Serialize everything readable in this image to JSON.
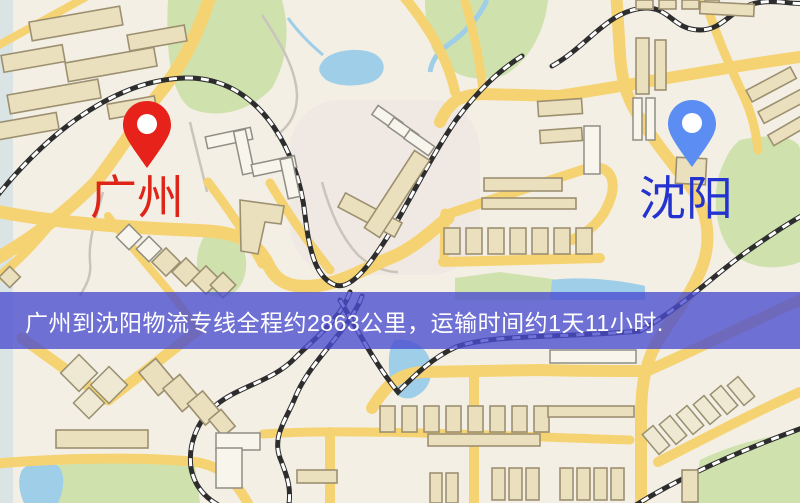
{
  "route_map": {
    "origin": {
      "name": "广州",
      "pin_color": "#e7221b",
      "label_color": "#df2418"
    },
    "destination": {
      "name": "沈阳",
      "pin_color": "#5b8df2",
      "label_color": "#2433cf"
    },
    "banner": {
      "text": "广州到沈阳物流专线全程约2863公里，运输时间约1天11小时.",
      "background": "#4a4bd0",
      "text_color": "#ffffff"
    },
    "route": {
      "distance_text": "约2863公里",
      "duration_text": "约1天11小时"
    },
    "palette": {
      "map_background": "#f3efe4",
      "road": "#f6d372",
      "building_tan": "#eae0bd",
      "building_white": "#f8f5ec",
      "green_area": "#cfe2ae",
      "water": "#9ecee8",
      "railway": "#2d2d2d"
    }
  }
}
